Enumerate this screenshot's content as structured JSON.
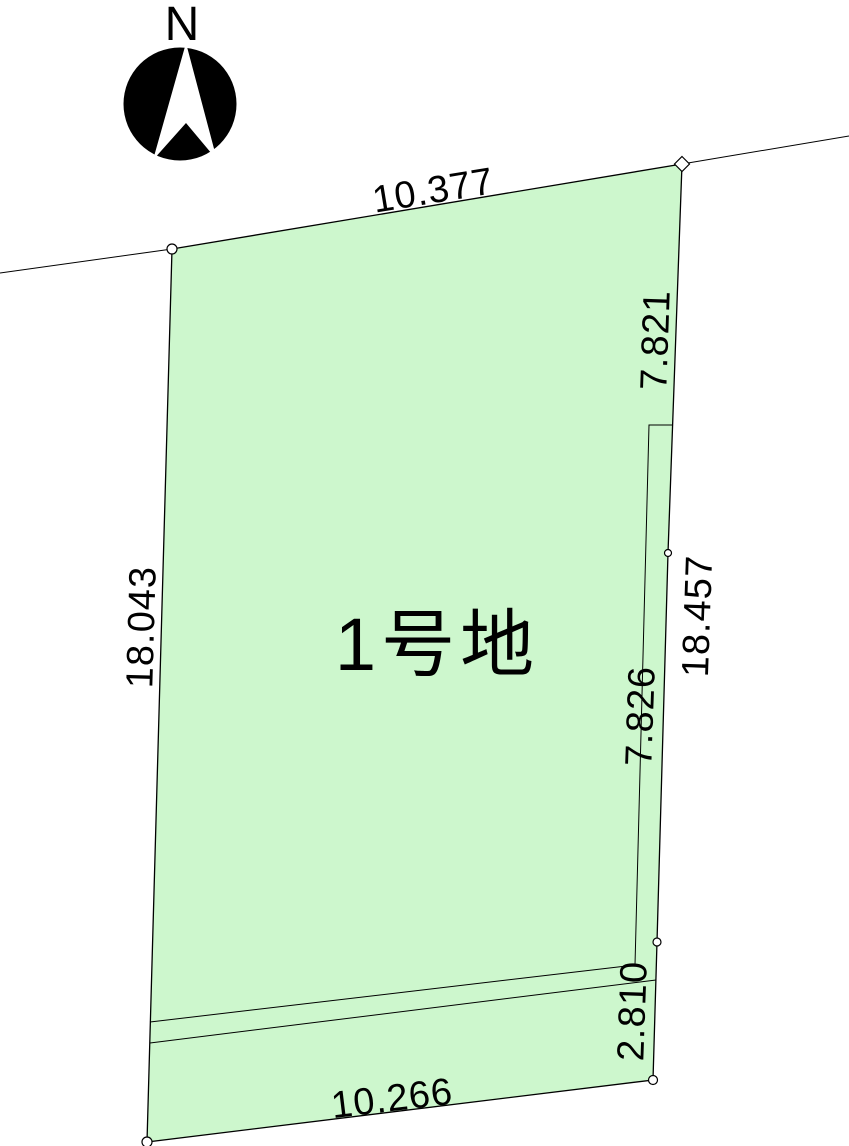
{
  "compass": {
    "label": "N"
  },
  "parcel": {
    "name": "1号地",
    "fill_color": "#cdf7cd",
    "line_color": "#000000"
  },
  "dimensions": {
    "top_edge": "10.377",
    "right_upper": "7.821",
    "right_total": "18.457",
    "right_middle": "7.826",
    "right_lower": "2.810",
    "bottom_edge": "10.266",
    "left_edge": "18.043"
  }
}
